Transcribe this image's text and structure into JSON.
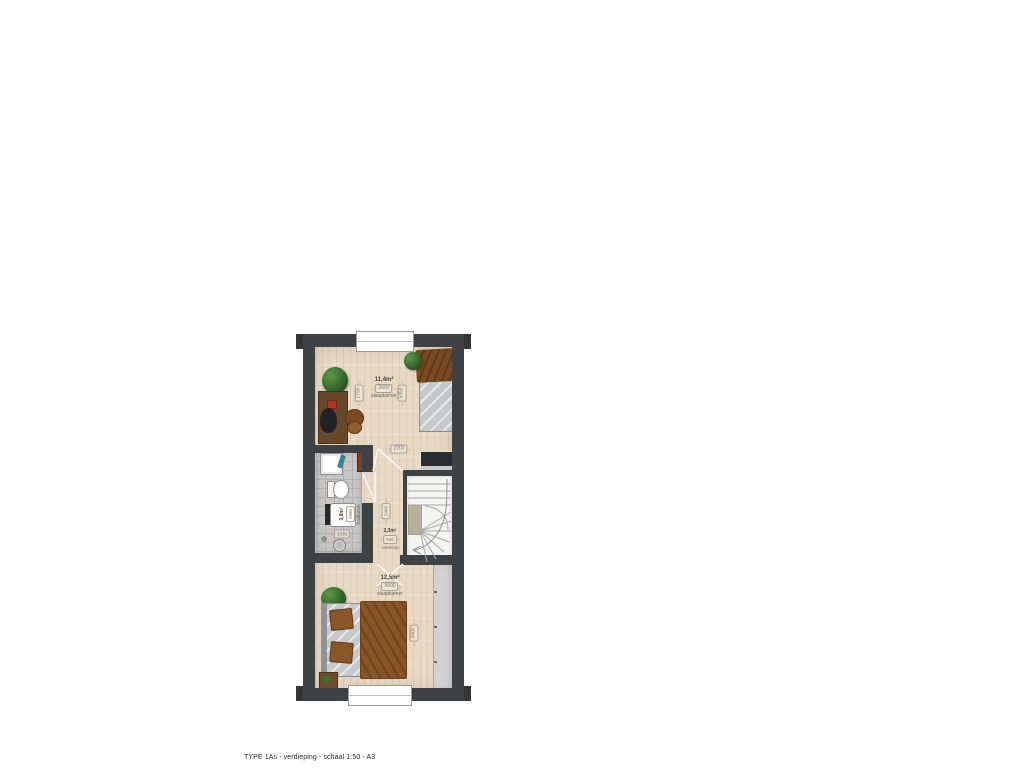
{
  "meta": {
    "caption": "TYPE 1As - verdieping - schaal 1:50 - A3",
    "drawing_type": "floor-plan",
    "scale": "1:50",
    "sheet": "A3",
    "floor": "verdieping"
  },
  "icons": {
    "arrow_left": "◁",
    "arrow_right": "▷"
  },
  "colors": {
    "wall": "#3f4245",
    "wood_floor": "#e8d9c5",
    "tile_floor": "#c7c6c4",
    "stair": "#f4f4f3",
    "duvet_brown": "#8a5526",
    "plant_green": "#35682c",
    "towel_teal": "#37858d"
  },
  "rooms": {
    "bedroom_top": {
      "area": "11,4m²",
      "width": "3600",
      "label": "slaapkamer",
      "dim_left": "2750",
      "dim_right": "5450",
      "door_dim": "2200"
    },
    "bathroom": {
      "area": "3,8m²",
      "depth": "2850",
      "label": "badkamer",
      "width": "1330"
    },
    "landing": {
      "area": "2,3m²",
      "width": "940",
      "label": "overloop",
      "depth": "2400"
    },
    "bedroom_bottom": {
      "area": "12,5m²",
      "width": "3600",
      "label": "slaapkamer",
      "dim_right": "3400"
    }
  }
}
